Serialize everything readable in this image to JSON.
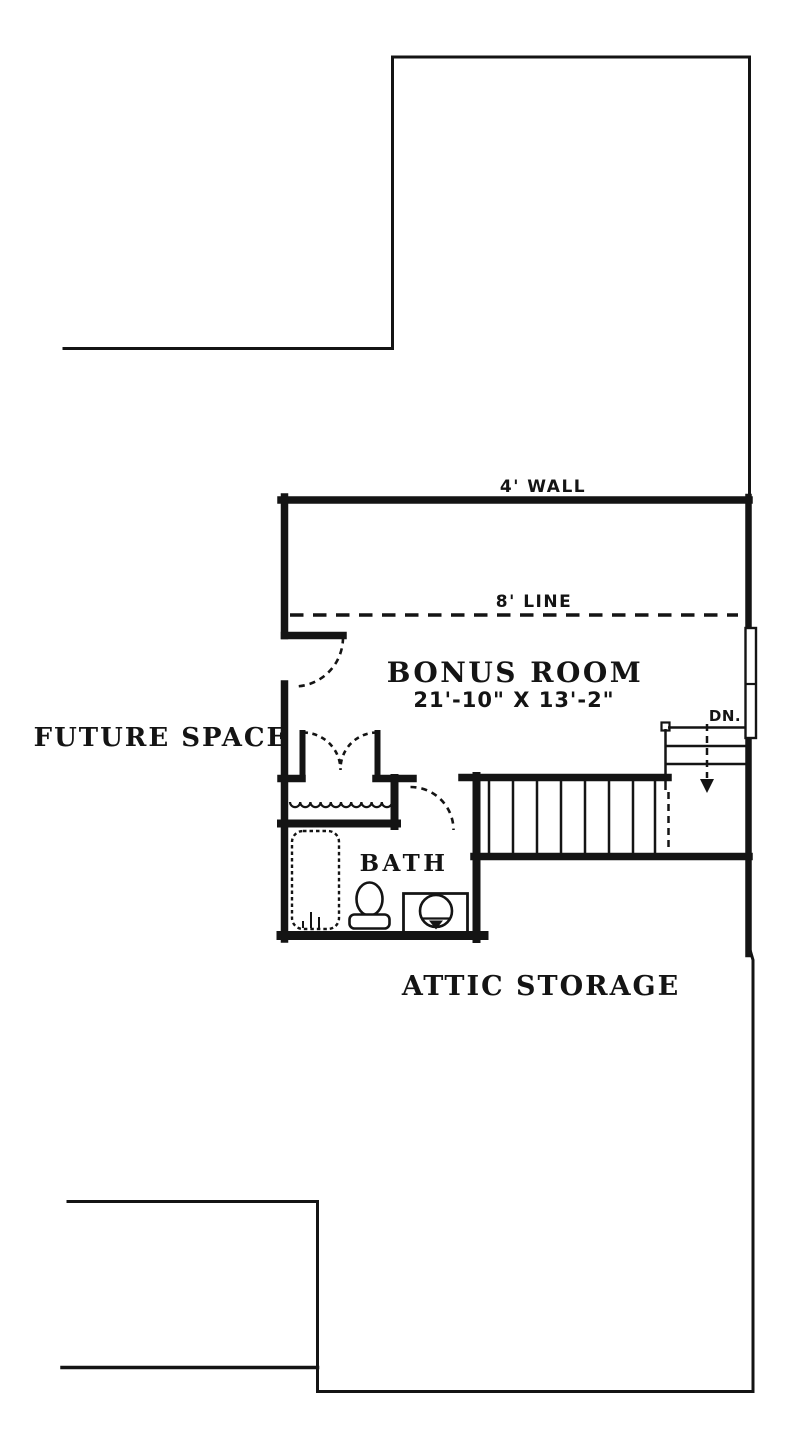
{
  "title": "Bonus room floor plan",
  "colors": {
    "ink": "#141414",
    "background": "#ffffff"
  },
  "plan": {
    "rooms": {
      "future_space": {
        "label": "FUTURE SPACE"
      },
      "bonus_room": {
        "label": "BONUS ROOM",
        "dimensions": "21'-10\" X 13'-2\""
      },
      "bath": {
        "label": "BATH"
      },
      "attic_storage": {
        "label": "ATTIC STORAGE"
      }
    },
    "annotations": {
      "wall_height": {
        "label": "4' WALL"
      },
      "ceiling_line": {
        "label": "8' LINE"
      },
      "stairs_down": {
        "label": "DN."
      }
    }
  }
}
